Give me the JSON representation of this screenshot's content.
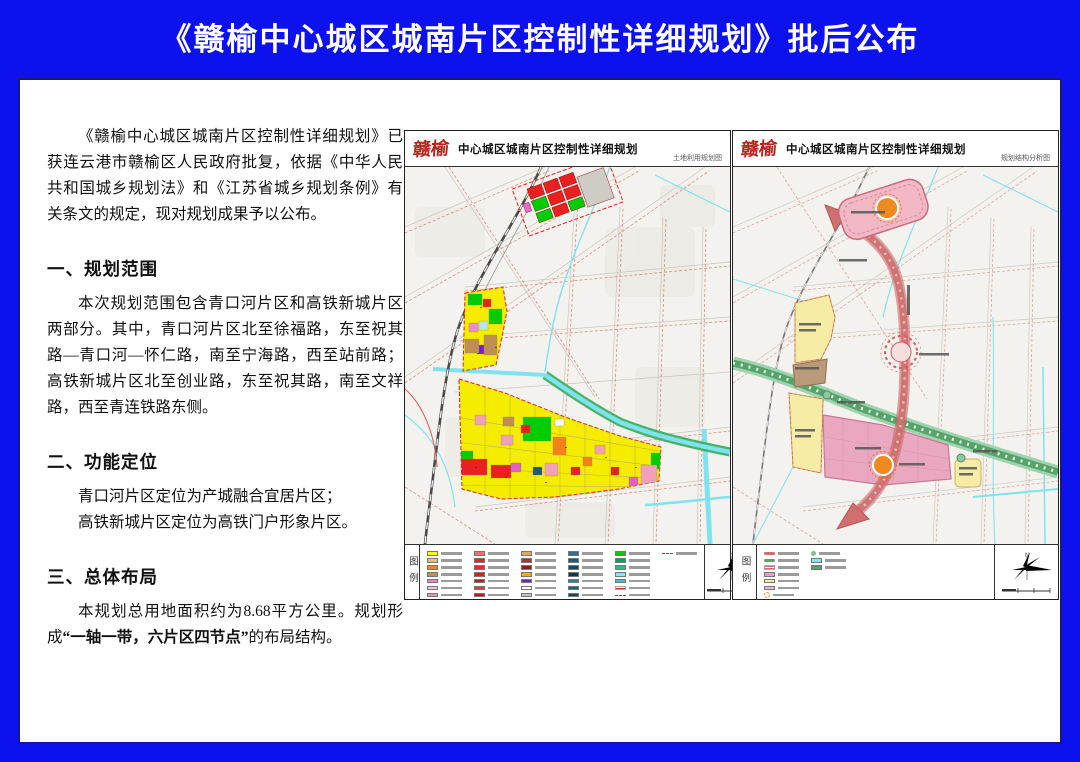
{
  "page": {
    "title": "《赣榆中心城区城南片区控制性详细规划》批后公布"
  },
  "article": {
    "intro": "《赣榆中心城区城南片区控制性详细规划》已获连云港市赣榆区人民政府批复，依据《中华人民共和国城乡规划法》和《江苏省城乡规划条例》有关条文的规定，现对规划成果予以公布。",
    "section1": {
      "heading": "一、规划范围",
      "body": "本次规划范围包含青口河片区和高铁新城片区两部分。其中，青口河片区北至徐福路，东至祝其路—青口河—怀仁路，南至宁海路，西至站前路；高铁新城片区北至创业路，东至祝其路，南至文祥路，西至青连铁路东侧。"
    },
    "section2": {
      "heading": "二、功能定位",
      "line1": "青口河片区定位为产城融合宜居片区；",
      "line2": "高铁新城片区定位为高铁门户形象片区。"
    },
    "section3": {
      "heading": "三、总体布局",
      "pre": "本规划总用地面积约为8.68平方公里。规划形成",
      "bold": "“一轴一带，六片区四节点”",
      "post": "的布局结构。"
    }
  },
  "maps": [
    {
      "logo": "赣榆",
      "title": "中心城区城南片区控制性详细规划",
      "subtitle": "土地利用规划图",
      "legend_title": "图例",
      "compass": "N"
    },
    {
      "logo": "赣榆",
      "title": "中心城区城南片区控制性详细规划",
      "subtitle": "规划结构分析图",
      "legend_title": "图例",
      "compass": "N"
    }
  ],
  "legend1_swatches": [
    [
      "#ffff00",
      "#f6b96e",
      "#f2821a",
      "#bf8e52",
      "#ee82d2",
      "#f8c7cd",
      "#ee92a2"
    ],
    [
      "#f4726c",
      "#ee2222",
      "#e42a2a",
      "#d81f1f",
      "#ce1a1a",
      "#e23838",
      "#c41616"
    ],
    [
      "#e8a35e",
      "#a83434",
      "#8f1f1f",
      "#f2a81c",
      "#7a1fd0",
      "#ffffff",
      "#bcc6cc"
    ],
    [
      "#2e6f8e",
      "#1f5a74",
      "#16485e",
      "#0f3a4e",
      "#2a7f9e",
      "#1a6276",
      "#0c4c62"
    ],
    [
      "#00cc00",
      "#00aa55",
      "#2fb98e",
      "#7fe8f2",
      "#36c6d8",
      "stripe:#e02020",
      "dash:#e02020"
    ],
    [
      "dash:#e02020"
    ]
  ],
  "legend2_swatches": [
    [
      "axis:#d96a6a",
      "belt:#57a46b",
      "stripe:#e06a6a",
      "#e8a0bc",
      "#f7eea2",
      "#f2b8c6",
      "node:#f08a1e"
    ],
    [
      "dot:#7fbf8f",
      "#7fe8f2",
      "#57a46b"
    ]
  ],
  "palette": {
    "banner_blue": "#0d11ee",
    "map_background": "#f4f2ee",
    "residential_yellow": "#f6ec00",
    "park_green": "#00cc00",
    "commercial_red": "#e82020",
    "water_cyan": "#7fe2ef",
    "belt_green": "#57a46b",
    "axis_red": "#cf6f6f",
    "district_pink": "#e9a8c0",
    "district_yellow": "#f7eca6",
    "node_orange": "#f08a1e",
    "road_dash_red": "#d97f72"
  }
}
